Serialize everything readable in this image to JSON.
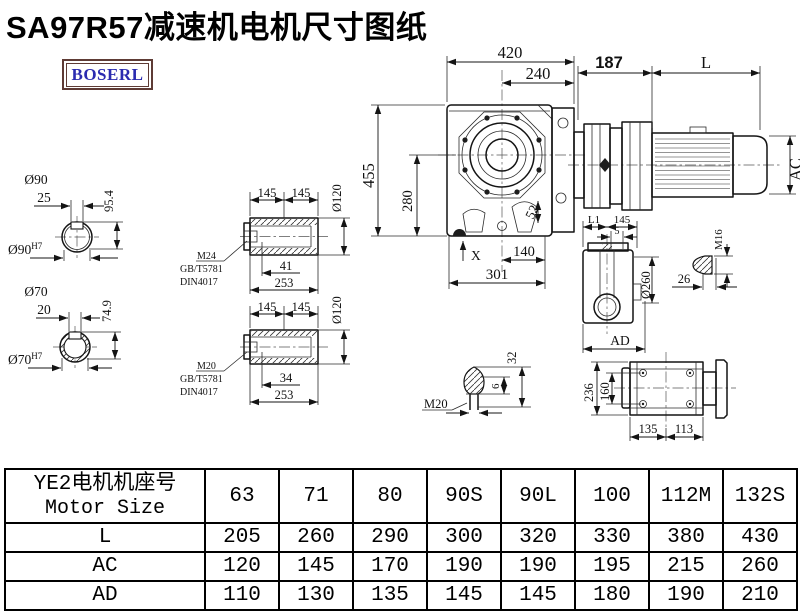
{
  "title": "SA97R57减速机电机尺寸图纸",
  "logo": {
    "text": "BOSERL"
  },
  "colors": {
    "line": "#141414",
    "logo_text": "#2b2bb0",
    "logo_border": "#5e3b35"
  },
  "dims": {
    "s1_dia": "Ø90",
    "s1_len": "25",
    "s1_h": "95.4",
    "s1_bore": "Ø90",
    "s1_tol": "H7",
    "s2_dia": "Ø70",
    "s2_len": "20",
    "s2_h": "74.9",
    "s2_bore": "Ø70",
    "s2_tol": "H7",
    "h1_a": "145",
    "h1_b": "145",
    "h1_dia": "Ø120",
    "h1_thread": "M24",
    "h1_std1": "GB/T5781",
    "h1_std2": "DIN4017",
    "h1_depth": "41",
    "h1_len": "253",
    "h2_a": "145",
    "h2_b": "145",
    "h2_dia": "Ø120",
    "h2_thread": "M20",
    "h2_std1": "GB/T5781",
    "h2_std2": "DIN4017",
    "h2_depth": "34",
    "h2_len": "253",
    "main_w": "420",
    "main_w2": "240",
    "main_h": "455",
    "main_h2": "280",
    "main_52": "52",
    "main_140": "140",
    "main_301": "301",
    "main_x": "X",
    "mot_187": "187",
    "mot_l": "L",
    "mot_ac": "AC",
    "side_l1": "L1",
    "side_145": "145",
    "side_5": "5",
    "side_dia": "Ø260",
    "side_ad": "AD",
    "side_m16": "M16",
    "side_26": "26",
    "plug_m20": "M20",
    "plug_6": "6",
    "plug_32": "32",
    "top_236": "236",
    "top_160": "160",
    "top_135": "135",
    "top_113": "113"
  },
  "table": {
    "header_cn": "YE2电机机座号",
    "header_en": "Motor Size",
    "columns": [
      "63",
      "71",
      "80",
      "90S",
      "90L",
      "100",
      "112M",
      "132S"
    ],
    "rows": [
      {
        "label": "L",
        "values": [
          "205",
          "260",
          "290",
          "300",
          "320",
          "330",
          "380",
          "430"
        ]
      },
      {
        "label": "AC",
        "values": [
          "120",
          "145",
          "170",
          "190",
          "190",
          "195",
          "215",
          "260"
        ]
      },
      {
        "label": "AD",
        "values": [
          "110",
          "130",
          "135",
          "145",
          "145",
          "180",
          "190",
          "210"
        ]
      }
    ]
  }
}
